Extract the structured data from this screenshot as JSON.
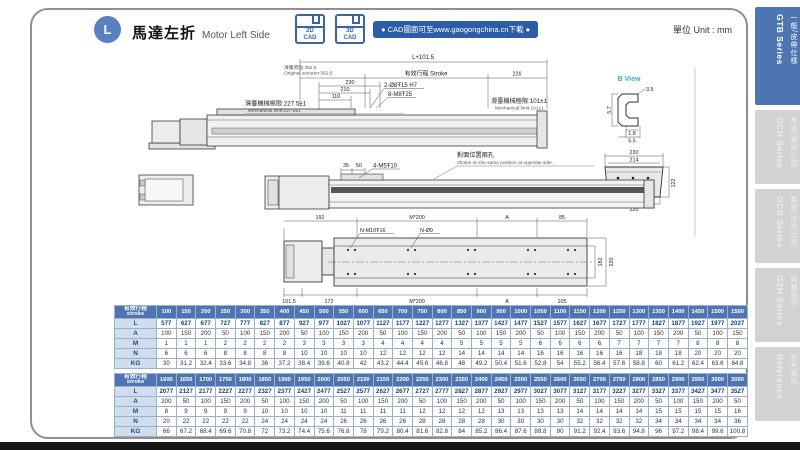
{
  "page": {
    "badge_letter": "L",
    "title_zh": "馬達左折",
    "title_en": "Motor Left Side",
    "cad_buttons": [
      {
        "line1": "2D",
        "line2": "CAD"
      },
      {
        "line1": "3D",
        "line2": "CAD"
      }
    ],
    "cad_banner": "● CAD圖面可至www.gaogongchina.cn下載 ●",
    "unit_label": "單位 Unit : mm"
  },
  "colors": {
    "table_header_blue": "#4e74b2",
    "banner_blue": "#2d5ca8",
    "active_tab_blue": "#4e74b2",
    "view_label_blue": "#3fa6dc",
    "row_label_bg": "#cfdded"
  },
  "sidebar": {
    "tabs": [
      {
        "zh": "一般/皮帶仕樣",
        "en": "GTB Series",
        "active": true
      },
      {
        "zh": "無塵/螺桿仕樣",
        "en": "GCH Series",
        "active": false
      },
      {
        "zh": "無塵/皮帶仕樣",
        "en": "GCB Series",
        "active": false
      },
      {
        "zh": "齒輪齒條",
        "en": "GZH Series",
        "active": false
      },
      {
        "zh": "參考資料",
        "en": "Reference",
        "active": false
      }
    ]
  },
  "drawing": {
    "top_view": {
      "total": "L+101.5",
      "origin_zh": "滑臺原點:352.5",
      "origin_en": "Original actuator:352.5",
      "stroke": "有效行程 Stroke",
      "d226": "226",
      "d230": "230",
      "d210": "210",
      "d110": "110",
      "holes1": "2-Ø8Ŧ15 H7",
      "holes2": "8-M8Ŧ25",
      "limitL_zh": "滑臺機械極限:227.5±1",
      "limitL_en": "Mechanical limit:227.5±1",
      "limitR_zh": "滑臺機械極限:101±1",
      "limitR_en": "Mechanical limit:101±1"
    },
    "b_view": {
      "title": "B View",
      "d35": "3.5",
      "d57": "5.7",
      "d18": "1.8",
      "d55": "5.5"
    },
    "section": {
      "d230": "230",
      "d214": "214",
      "d122": "122",
      "d220": "220",
      "label": "B"
    },
    "side_view": {
      "d35": "35",
      "d50": "50",
      "holes": "4-M5Ŧ10",
      "note_zh": "對面位置兩孔",
      "note_en": "2holes on the same position at opposite side."
    },
    "plan_view": {
      "d192": "192",
      "m200_top": "M*200",
      "a_top": "A",
      "d85": "85",
      "holesA": "N-M10Ŧ16",
      "holesB": "N-Ø9",
      "d182": "182",
      "d220": "220",
      "d1015": "101.5",
      "d172": "172",
      "m200_bot": "M*200",
      "a_bot": "A",
      "d105": "105"
    }
  },
  "table": {
    "corner_zh": "有效行程",
    "corner_en": "stroke",
    "row_labels": [
      "L",
      "A",
      "M",
      "N",
      "KG"
    ],
    "sections": [
      {
        "strokes": [
          100,
          150,
          200,
          250,
          300,
          350,
          400,
          450,
          500,
          550,
          600,
          650,
          700,
          750,
          800,
          850,
          900,
          950,
          1000,
          1050,
          1100,
          1150,
          1200,
          1250,
          1300,
          1350,
          1400,
          1450,
          1500,
          1550
        ],
        "rows": {
          "L": [
            577,
            627,
            677,
            727,
            777,
            827,
            877,
            927,
            977,
            1027,
            1077,
            1127,
            1177,
            1227,
            1277,
            1327,
            1377,
            1427,
            1477,
            1527,
            1577,
            1627,
            1677,
            1727,
            1777,
            1827,
            1877,
            1927,
            1977,
            2027
          ],
          "A": [
            100,
            150,
            200,
            50,
            100,
            150,
            200,
            50,
            100,
            150,
            200,
            50,
            100,
            150,
            200,
            50,
            100,
            150,
            200,
            50,
            100,
            150,
            200,
            50,
            100,
            150,
            200,
            50,
            100,
            150
          ],
          "M": [
            1,
            1,
            1,
            2,
            2,
            2,
            2,
            3,
            3,
            3,
            3,
            4,
            4,
            4,
            4,
            5,
            5,
            5,
            5,
            6,
            6,
            6,
            6,
            7,
            7,
            7,
            7,
            8,
            8,
            8
          ],
          "N": [
            6,
            6,
            6,
            8,
            8,
            8,
            8,
            10,
            10,
            10,
            10,
            12,
            12,
            12,
            12,
            14,
            14,
            14,
            14,
            16,
            16,
            16,
            16,
            16,
            18,
            18,
            18,
            20,
            20,
            20
          ],
          "KG": [
            30,
            31.2,
            32.4,
            33.6,
            34.8,
            36,
            37.2,
            38.4,
            39.6,
            40.8,
            42,
            43.2,
            44.4,
            45.6,
            46.8,
            48,
            49.2,
            50.4,
            51.6,
            52.8,
            54,
            55.2,
            56.4,
            57.6,
            58.8,
            60,
            61.2,
            62.4,
            63.6,
            64.8
          ]
        }
      },
      {
        "strokes": [
          1600,
          1650,
          1700,
          1750,
          1800,
          1850,
          1900,
          1950,
          2000,
          2050,
          2100,
          2150,
          2200,
          2250,
          2300,
          2350,
          2400,
          2450,
          2500,
          2550,
          2600,
          2650,
          2700,
          2750,
          2800,
          2850,
          2900,
          2950,
          3000,
          3050
        ],
        "rows": {
          "L": [
            2077,
            2127,
            2177,
            2227,
            2277,
            2327,
            2377,
            2427,
            2477,
            2527,
            2577,
            2627,
            2677,
            2727,
            2777,
            2827,
            2877,
            2927,
            2977,
            3027,
            3077,
            3127,
            3177,
            3227,
            3277,
            3327,
            3377,
            3427,
            3477,
            3527
          ],
          "A": [
            200,
            50,
            100,
            150,
            200,
            50,
            100,
            150,
            200,
            50,
            100,
            150,
            200,
            50,
            100,
            150,
            200,
            50,
            100,
            150,
            200,
            50,
            100,
            150,
            200,
            50,
            100,
            150,
            200,
            50
          ],
          "M": [
            8,
            9,
            9,
            9,
            9,
            10,
            10,
            10,
            10,
            11,
            11,
            11,
            11,
            12,
            12,
            12,
            12,
            13,
            13,
            13,
            13,
            14,
            14,
            14,
            14,
            15,
            15,
            15,
            15,
            16
          ],
          "N": [
            20,
            22,
            22,
            22,
            22,
            24,
            24,
            24,
            24,
            26,
            26,
            26,
            26,
            28,
            28,
            28,
            28,
            30,
            30,
            30,
            30,
            32,
            32,
            32,
            32,
            34,
            34,
            34,
            34,
            36
          ],
          "KG": [
            66,
            67.2,
            68.4,
            69.6,
            70.8,
            72,
            73.2,
            74.4,
            75.6,
            76.8,
            78,
            79.2,
            80.4,
            81.6,
            82.8,
            84,
            85.2,
            86.4,
            87.6,
            88.8,
            90,
            91.2,
            92.4,
            93.6,
            94.8,
            96,
            97.2,
            98.4,
            99.6,
            100.8
          ]
        }
      }
    ]
  }
}
